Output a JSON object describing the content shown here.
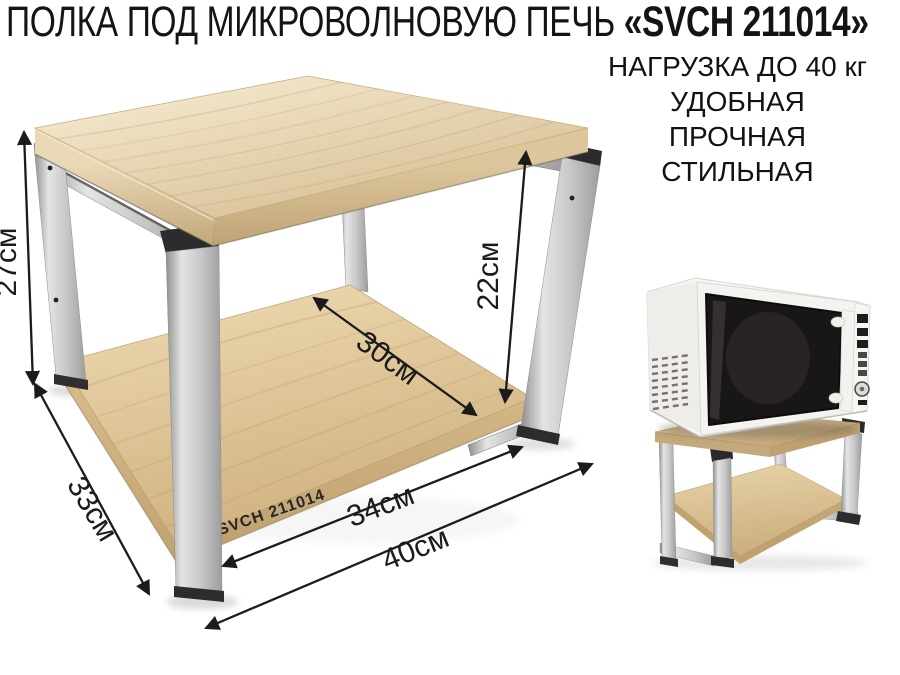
{
  "title": {
    "prefix": "ПОЛКА ПОД МИКРОВОЛНОВУЮ ПЕЧЬ ",
    "model": "«SVCH 211014»"
  },
  "claims": {
    "load": "НАГРУЗКА ДО 40 кг",
    "line1": "УДОБНАЯ",
    "line2": "ПРОЧНАЯ",
    "line3": "СТИЛЬНАЯ"
  },
  "dimensions": {
    "overall_height": "27см",
    "overall_depth": "33см",
    "clearance_height": "22см",
    "shelf_depth": "30см",
    "shelf_width": "34см",
    "overall_width": "40см"
  },
  "shelf_print": "SVCH 211014",
  "colors": {
    "wood_light": "#eddfc0",
    "wood_dark": "#cbae7c",
    "metal": "#c6c6c6",
    "cap_black": "#2b2b2b",
    "ink": "#1b1b1b",
    "microwave_body": "#f6f5f3",
    "microwave_glass": "#191617"
  }
}
